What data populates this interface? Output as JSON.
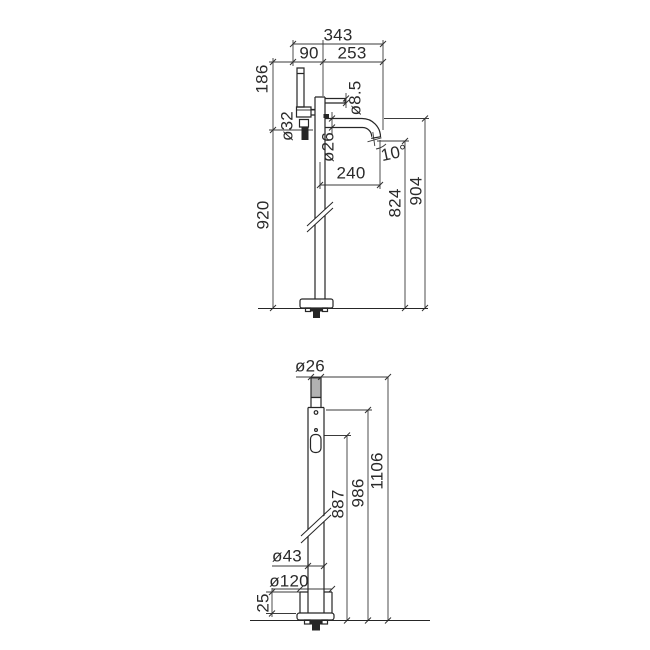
{
  "style": {
    "background": "#ffffff",
    "line_color": "#2a2a2a",
    "dim_line_color": "#3a3a3a",
    "text_color": "#2a2a2a"
  },
  "front": {
    "total_width": "343",
    "left_offset": "90",
    "right_offset": "253",
    "head_height": "186",
    "total_height": "920",
    "column_diameter": "ø32",
    "lever_diameter": "ø8.5",
    "spout_diameter": "ø26",
    "spout_reach": "240",
    "spout_angle": "10°",
    "outlet_height": "824",
    "spout_top_height": "904"
  },
  "side": {
    "handshower_diameter": "ø26",
    "total_height": "1106",
    "body_top_height": "986",
    "lever_height": "887",
    "column_diameter": "ø43",
    "base_diameter": "ø120",
    "base_plate_height": "25"
  }
}
